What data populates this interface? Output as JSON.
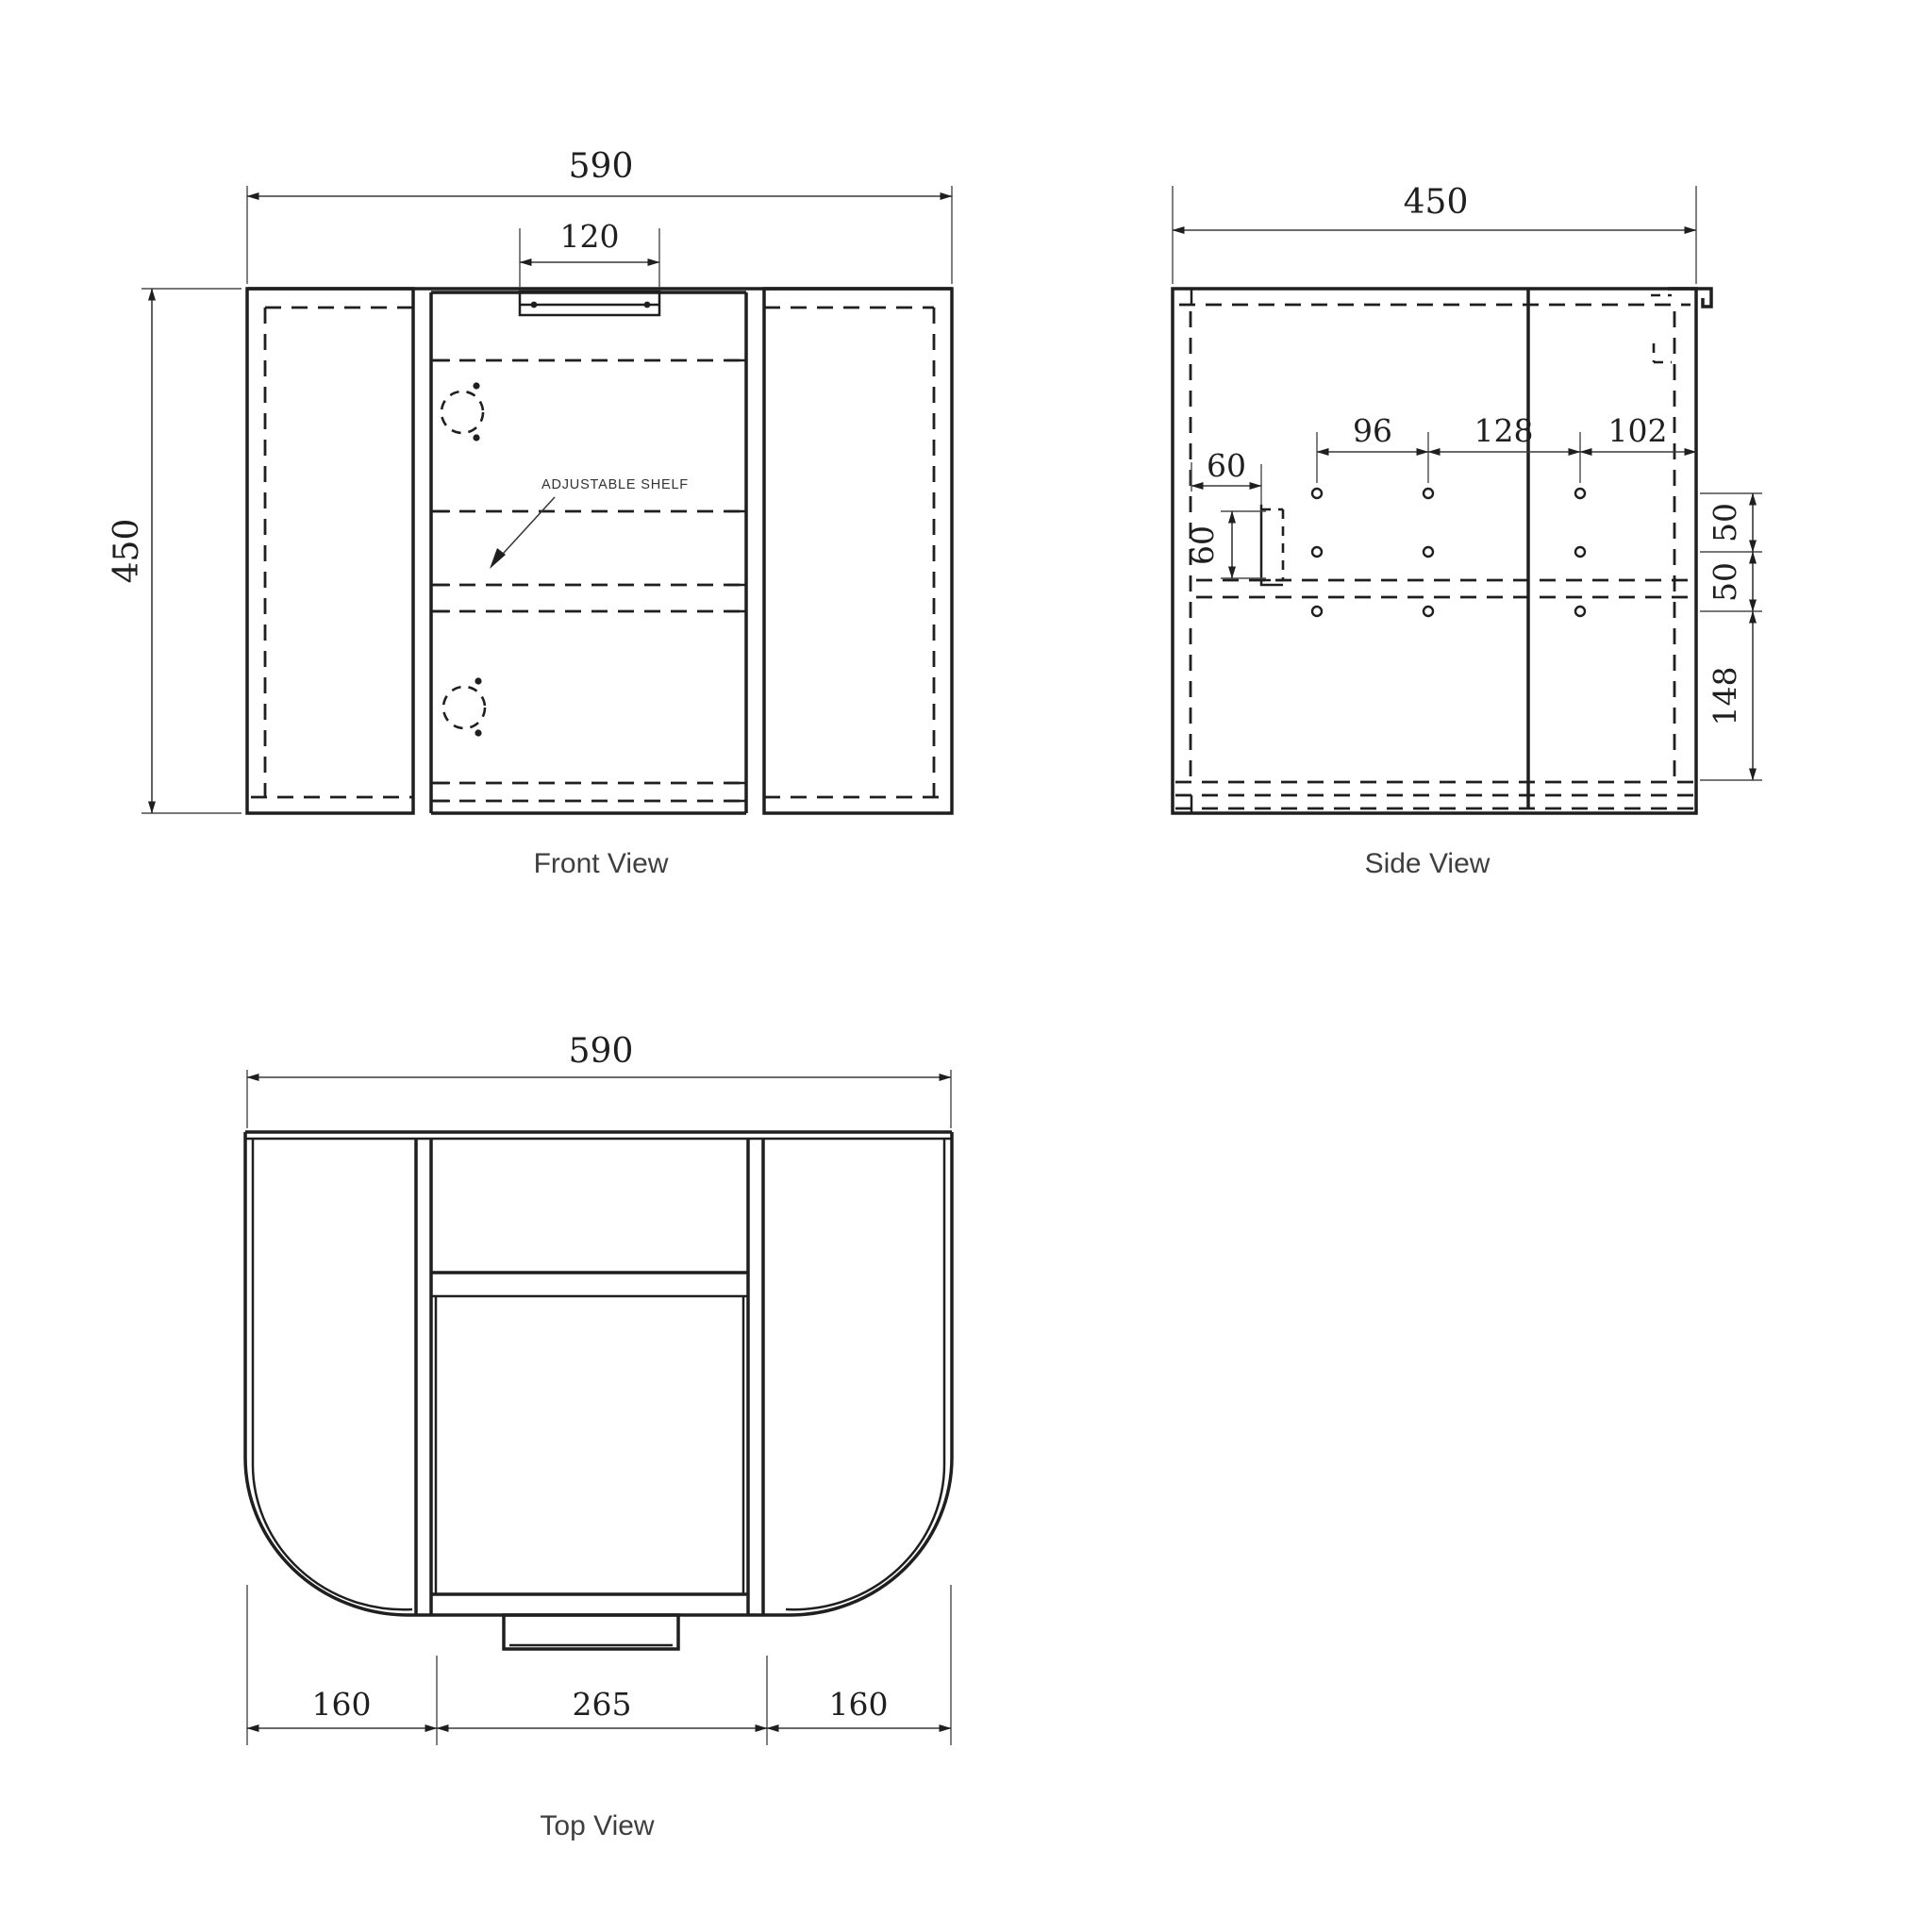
{
  "colors": {
    "background": "#ffffff",
    "object_line": "#1f1f1f",
    "dimension_line": "#3a3a3a",
    "caption_text": "#3f3f3f"
  },
  "front_view": {
    "caption": "Front View",
    "width": "590",
    "handle_width": "120",
    "height": "450",
    "shelf_label": "ADJUSTABLE SHELF"
  },
  "side_view": {
    "caption": "Side View",
    "depth": "450",
    "hole_spacing_a": "96",
    "hole_spacing_b": "128",
    "hole_spacing_c": "102",
    "bracket_offset": "60",
    "bracket_size": "60",
    "hole_gap_top": "50",
    "hole_gap_bottom": "50",
    "bottom_clearance": "148"
  },
  "top_view": {
    "caption": "Top View",
    "width": "590",
    "left_section": "160",
    "center_section": "265",
    "right_section": "160"
  }
}
